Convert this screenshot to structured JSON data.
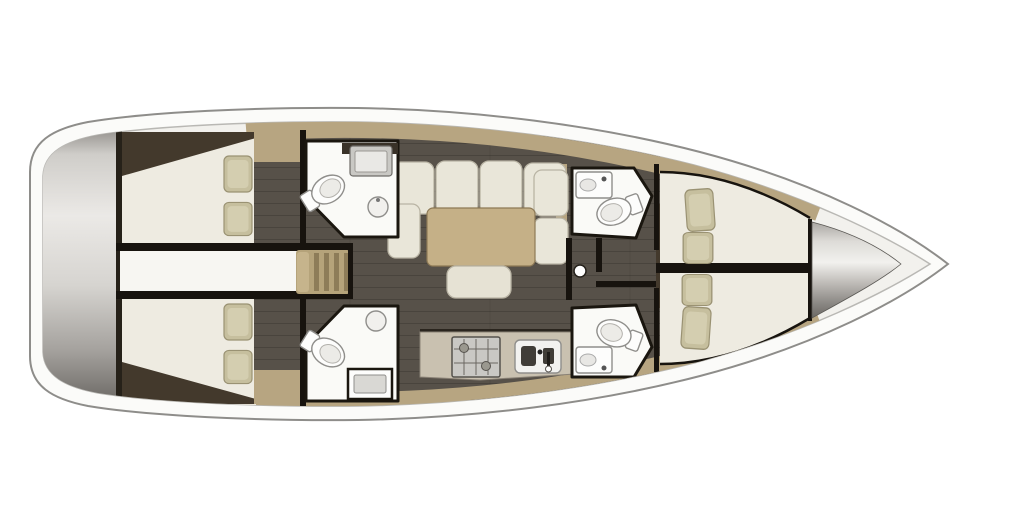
{
  "figure": {
    "type": "sailboat-deck-plan",
    "view": "top-down",
    "bow_direction": "right"
  },
  "layout": {
    "aft_double_cabins": 2,
    "forward_v_berths": 2,
    "heads_bathrooms": 4,
    "toilets": 4,
    "bathroom_sinks": 4,
    "round_basins": 2,
    "pillows_total": 8,
    "salon": {
      "sofa_shape": "U",
      "table": 1,
      "ottoman": 1
    },
    "galley": {
      "stove": 1,
      "double_sink": 1
    },
    "companionway_steps": 1,
    "swim_platform": 1,
    "bow_locker": 1,
    "mast": 1
  },
  "colors": {
    "background": "#ffffff",
    "hull_band": "#fbfbf9",
    "hull_outline": "#8e8d8a",
    "interior_base": "#f2f1ed",
    "deck_line": "#b9b8b4",
    "side_deck_wood": "#b7a581",
    "walnut_dark": "#43392c",
    "floor_dark": "#575149",
    "bed_cream": "#eeebe1",
    "corridor_white": "#f7f6f2",
    "pillow_fill": "#c6bf9e",
    "pillow_inner": "#d4ceb0",
    "sofa_fill": "#e9e6d9",
    "table_wood": "#c5b087",
    "ottoman_fill": "#e6e2d4",
    "counter_fill": "#c9c1b0",
    "stove_fill": "#c9c8c4",
    "sink_bowl_dark": "#403d38",
    "fixture_fill": "#fdfdfc",
    "head_floor": "#fafaf7",
    "wall_black": "#17130e",
    "step_wood": "#b5a37a",
    "step_slat": "#8d7c58",
    "step_cap": "#c6b48c",
    "counter_edge_dark": "#2a251e",
    "transom_wall": "#262119",
    "mast_fill": "#ffffff"
  }
}
